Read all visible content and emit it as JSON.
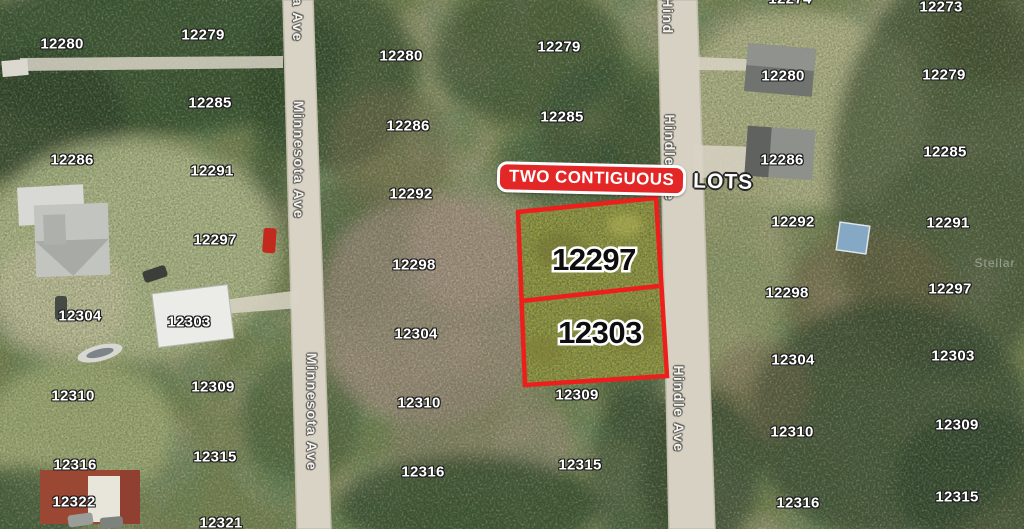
{
  "colors": {
    "accent_red": "#e32726",
    "lot_border_red": "#ee1e1c",
    "lot_fill_olive": "#a2a244",
    "road_gray": "#d8d3c5"
  },
  "banner": {
    "box_text": "TWO CONTIGUOUS",
    "outside_text": "LOTS"
  },
  "highlighted_lots": [
    {
      "number": "12297"
    },
    {
      "number": "12303"
    }
  ],
  "streets": {
    "west_road": "Minnesota Ave",
    "east_road": "Hindle Ave"
  },
  "road_labels": [
    {
      "text": "a Ave",
      "x": 298,
      "y": 20
    },
    {
      "text": "Minnesota Ave",
      "x": 299,
      "y": 160
    },
    {
      "text": "Minnesota Ave",
      "x": 312,
      "y": 412
    },
    {
      "text": "Hind",
      "x": 668,
      "y": 16
    },
    {
      "text": "Hindle Ave",
      "x": 670,
      "y": 158
    },
    {
      "text": "Hindle Ave",
      "x": 679,
      "y": 409
    }
  ],
  "parcel_labels": [
    {
      "text": "12280",
      "x": 62,
      "y": 44
    },
    {
      "text": "12286",
      "x": 72,
      "y": 160
    },
    {
      "text": "12304",
      "x": 80,
      "y": 316
    },
    {
      "text": "12310",
      "x": 73,
      "y": 396
    },
    {
      "text": "12316",
      "x": 75,
      "y": 465
    },
    {
      "text": "12322",
      "x": 74,
      "y": 502
    },
    {
      "text": "12279",
      "x": 203,
      "y": 35
    },
    {
      "text": "12285",
      "x": 210,
      "y": 103
    },
    {
      "text": "12291",
      "x": 212,
      "y": 171
    },
    {
      "text": "12297",
      "x": 215,
      "y": 240
    },
    {
      "text": "12303",
      "x": 189,
      "y": 322
    },
    {
      "text": "12309",
      "x": 213,
      "y": 387
    },
    {
      "text": "12315",
      "x": 215,
      "y": 457
    },
    {
      "text": "12321",
      "x": 221,
      "y": 523
    },
    {
      "text": "12280",
      "x": 401,
      "y": 56
    },
    {
      "text": "12286",
      "x": 408,
      "y": 126
    },
    {
      "text": "12292",
      "x": 411,
      "y": 194
    },
    {
      "text": "12298",
      "x": 414,
      "y": 265
    },
    {
      "text": "12304",
      "x": 416,
      "y": 334
    },
    {
      "text": "12310",
      "x": 419,
      "y": 403
    },
    {
      "text": "12316",
      "x": 423,
      "y": 472
    },
    {
      "text": "12279",
      "x": 559,
      "y": 47
    },
    {
      "text": "12285",
      "x": 562,
      "y": 117
    },
    {
      "text": "12309",
      "x": 577,
      "y": 395
    },
    {
      "text": "12315",
      "x": 580,
      "y": 465
    },
    {
      "text": "12274",
      "x": 790,
      "y": -1
    },
    {
      "text": "12280",
      "x": 783,
      "y": 76
    },
    {
      "text": "12286",
      "x": 782,
      "y": 160
    },
    {
      "text": "12292",
      "x": 793,
      "y": 222
    },
    {
      "text": "12298",
      "x": 787,
      "y": 293
    },
    {
      "text": "12304",
      "x": 793,
      "y": 360
    },
    {
      "text": "12310",
      "x": 792,
      "y": 432
    },
    {
      "text": "12316",
      "x": 798,
      "y": 503
    },
    {
      "text": "12273",
      "x": 941,
      "y": 7
    },
    {
      "text": "12279",
      "x": 944,
      "y": 75
    },
    {
      "text": "12285",
      "x": 945,
      "y": 152
    },
    {
      "text": "12291",
      "x": 948,
      "y": 223
    },
    {
      "text": "12297",
      "x": 950,
      "y": 289
    },
    {
      "text": "12303",
      "x": 953,
      "y": 356
    },
    {
      "text": "12309",
      "x": 957,
      "y": 425
    },
    {
      "text": "12315",
      "x": 957,
      "y": 497
    }
  ],
  "watermark": "Stellar"
}
